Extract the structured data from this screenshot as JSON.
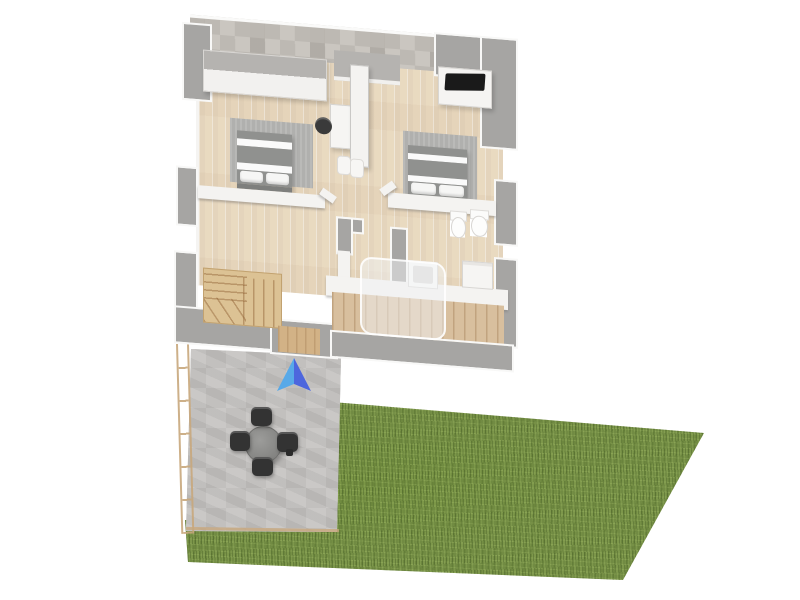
{
  "scene": {
    "description": "3D rendered floor plan of an upper floor with two bedrooms, bathroom, hallway staircase, stone patio with outdoor dining set, and a grass lawn",
    "rooms": [
      {
        "name": "bedroom-left",
        "furniture": [
          "wardrobe-closet",
          "double-bed",
          "area-rug",
          "desk",
          "desk-chair"
        ]
      },
      {
        "name": "bedroom-right",
        "furniture": [
          "tv-sideboard",
          "tv",
          "double-bed",
          "area-rug"
        ]
      },
      {
        "name": "bathroom",
        "furniture": [
          "bidet",
          "toilet",
          "washbasin",
          "shower-glass",
          "bath-cabinet"
        ]
      },
      {
        "name": "hallway",
        "furniture": [
          "staircase",
          "tall-wardrobe",
          "poufs",
          "closet-bar"
        ]
      }
    ],
    "outdoor": [
      {
        "name": "patio",
        "features": [
          "stone-pavers",
          "wood-railing",
          "round-table",
          "four-chairs"
        ]
      },
      {
        "name": "lawn",
        "features": [
          "grass"
        ]
      },
      {
        "name": "deck",
        "features": [
          "wood-planks"
        ]
      }
    ],
    "marker": {
      "name": "view-direction-arrow",
      "shape": "3d-arrow-pointing-up"
    }
  },
  "colors": {
    "floor-wood": "#ecdfc9",
    "stone-wall-a": "#cac6c0",
    "stone-wall-b": "#bdb9b3",
    "wall-gray": "#a6a5a3",
    "wall-white": "#f4f3f1",
    "rug-gray": "#b0b0ae",
    "bed-gray": "#90918f",
    "stairs-wood": "#dcc294",
    "deck-wood": "#d8bf9e",
    "paver-a": "#c7c5c3",
    "paver-b": "#bebcba",
    "grass-base": "#7d974b",
    "chair-dark": "#333333",
    "table-gray": "#8e8e8c",
    "railing-tan": "#c8a87d",
    "arrow-left": "#58a9e8",
    "arrow-right": "#4d66dd",
    "tv-black": "#1a1a1a"
  }
}
